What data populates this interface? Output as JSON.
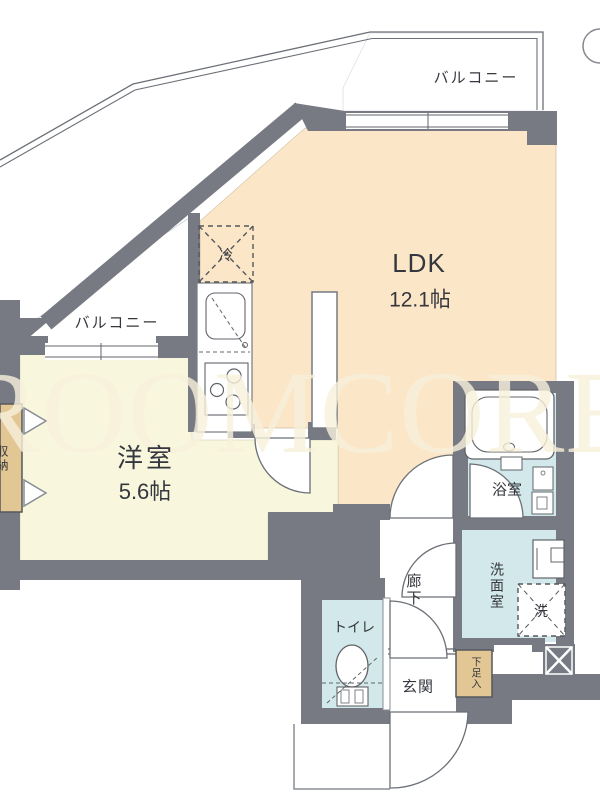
{
  "labels": {
    "balcony_top": "バルコニー",
    "balcony_left": "バルコニー",
    "ldk": "LDK",
    "ldk_size": "12.1帖",
    "western_room": "洋室",
    "western_size": "5.6帖",
    "refrigerator": "冷",
    "bathroom": "浴室",
    "washroom": "洗面室",
    "washer": "洗",
    "toilet": "トイレ",
    "hallway": "廊下",
    "entrance": "玄関",
    "shoe_cabinet": "下足入",
    "storage": "収納",
    "watermark": "ROOMCORE"
  },
  "colors": {
    "wall": "#777a82",
    "ldk": "#fbe6c8",
    "western": "#f8f7de",
    "wet": "#d2e8eb",
    "tan": "#e2c693",
    "line": "#60646c",
    "watermark": "#f8f1dc"
  }
}
